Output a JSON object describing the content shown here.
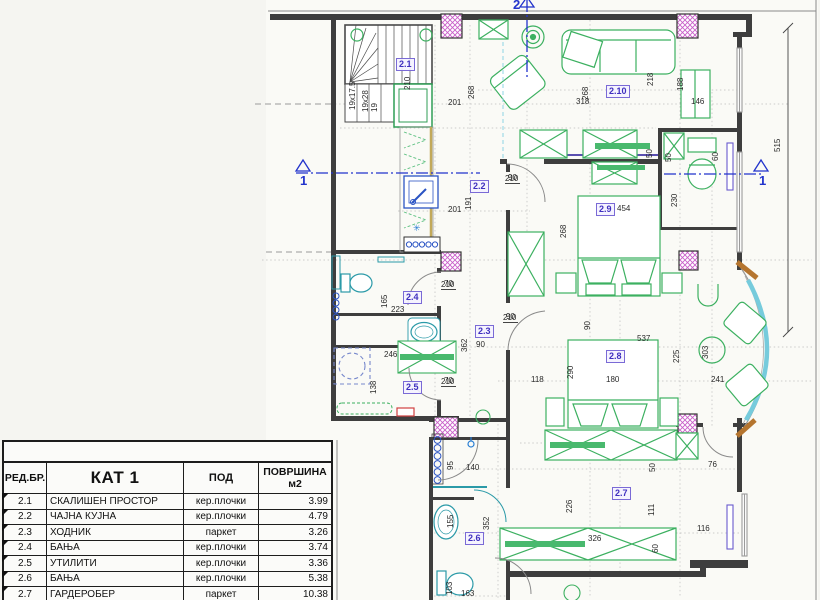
{
  "colors": {
    "wall": "#3e3e3e",
    "furniture_green": "#3cb060",
    "fixture_cyan": "#2b9aa8",
    "plumbing_blue": "#2b54c4",
    "column_magenta": "#c95fc9",
    "section_blue": "#2233cc",
    "bay_brown": "#b5752f",
    "counter_khaki": "#c2a95a",
    "accent_red": "#d04040",
    "label_purple": "#3f2fbf"
  },
  "table": {
    "headers": {
      "col_no": "РЕД.БР.",
      "col_name": "КАТ 1",
      "col_floor": "ПОД",
      "col_area_1": "ПОВРШИНА",
      "col_area_2": "м2"
    },
    "rows": [
      {
        "no": "2.1",
        "name": "СКАЛИШЕН ПРОСТОР",
        "floor": "кер.плочки",
        "area": "3.99"
      },
      {
        "no": "2.2",
        "name": "ЧАЈНА КУЈНА",
        "floor": "кер.плочки",
        "area": "4.79"
      },
      {
        "no": "2.3",
        "name": "ХОДНИК",
        "floor": "паркет",
        "area": "3.26"
      },
      {
        "no": "2.4",
        "name": "БАЊА",
        "floor": "кер.плочки",
        "area": "3.74"
      },
      {
        "no": "2.5",
        "name": "УТИЛИТИ",
        "floor": "кер.плочки",
        "area": "3.36"
      },
      {
        "no": "2.6",
        "name": "БАЊА",
        "floor": "кер.плочки",
        "area": "5.38"
      },
      {
        "no": "2.7",
        "name": "ГАРДЕРОБЕР",
        "floor": "паркет",
        "area": "10.38"
      },
      {
        "no": "2.8",
        "name": "СПАЛНА СОБА 1",
        "floor": "паркет",
        "area": "15.38"
      }
    ]
  },
  "plan": {
    "rooms": [
      {
        "t": "2.1",
        "x": 396,
        "y": 58
      },
      {
        "t": "2.2",
        "x": 470,
        "y": 180
      },
      {
        "t": "2.3",
        "x": 475,
        "y": 325
      },
      {
        "t": "2.4",
        "x": 403,
        "y": 291
      },
      {
        "t": "2.5",
        "x": 403,
        "y": 381
      },
      {
        "t": "2.6",
        "x": 465,
        "y": 532
      },
      {
        "t": "2.7",
        "x": 612,
        "y": 487
      },
      {
        "t": "2.8",
        "x": 606,
        "y": 350
      },
      {
        "t": "2.9",
        "x": 596,
        "y": 203
      },
      {
        "t": "2.10",
        "x": 606,
        "y": 85
      }
    ],
    "dims": [
      {
        "t": "210",
        "x": 404,
        "y": 90,
        "r": 1
      },
      {
        "t": "19x17.5",
        "x": 349,
        "y": 110,
        "r": 1
      },
      {
        "t": "19x28",
        "x": 362,
        "y": 112,
        "r": 1
      },
      {
        "t": "19",
        "x": 371,
        "y": 112,
        "r": 1
      },
      {
        "t": "201",
        "x": 448,
        "y": 99
      },
      {
        "t": "268",
        "x": 468,
        "y": 99,
        "r": 1
      },
      {
        "t": "201",
        "x": 448,
        "y": 206
      },
      {
        "t": "191",
        "x": 465,
        "y": 210,
        "r": 1
      },
      {
        "t": "268",
        "x": 582,
        "y": 100,
        "r": 1
      },
      {
        "t": "318",
        "x": 576,
        "y": 98
      },
      {
        "t": "218",
        "x": 647,
        "y": 86,
        "r": 1
      },
      {
        "t": "188",
        "x": 677,
        "y": 91,
        "r": 1
      },
      {
        "t": "146",
        "x": 691,
        "y": 98
      },
      {
        "t": "50",
        "x": 646,
        "y": 158,
        "r": 1
      },
      {
        "t": "50",
        "x": 665,
        "y": 162,
        "r": 1
      },
      {
        "t": "60",
        "x": 712,
        "y": 161,
        "r": 1
      },
      {
        "t": "230",
        "x": 671,
        "y": 207,
        "r": 1
      },
      {
        "t": "515",
        "x": 774,
        "y": 152,
        "r": 1
      },
      {
        "t": "454",
        "x": 617,
        "y": 205
      },
      {
        "t": "268",
        "x": 560,
        "y": 238,
        "r": 1
      },
      {
        "t": "223",
        "x": 391,
        "y": 306
      },
      {
        "t": "165",
        "x": 381,
        "y": 308,
        "r": 1
      },
      {
        "t": "246",
        "x": 384,
        "y": 351
      },
      {
        "t": "138",
        "x": 370,
        "y": 394,
        "r": 1
      },
      {
        "t": "362",
        "x": 461,
        "y": 352,
        "r": 1
      },
      {
        "t": "90",
        "x": 476,
        "y": 341
      },
      {
        "t": "90",
        "x": 584,
        "y": 330,
        "r": 1
      },
      {
        "t": "537",
        "x": 637,
        "y": 335
      },
      {
        "t": "290",
        "x": 567,
        "y": 379,
        "r": 1
      },
      {
        "t": "118",
        "x": 531,
        "y": 376
      },
      {
        "t": "180",
        "x": 606,
        "y": 376
      },
      {
        "t": "225",
        "x": 673,
        "y": 363,
        "r": 1
      },
      {
        "t": "303",
        "x": 702,
        "y": 359,
        "r": 1
      },
      {
        "t": "241",
        "x": 711,
        "y": 376
      },
      {
        "t": "95",
        "x": 447,
        "y": 470,
        "r": 1
      },
      {
        "t": "140",
        "x": 466,
        "y": 464
      },
      {
        "t": "155",
        "x": 447,
        "y": 528,
        "r": 1
      },
      {
        "t": "352",
        "x": 483,
        "y": 530,
        "r": 1
      },
      {
        "t": "103",
        "x": 446,
        "y": 595,
        "r": 1
      },
      {
        "t": "163",
        "x": 461,
        "y": 590
      },
      {
        "t": "226",
        "x": 566,
        "y": 513,
        "r": 1
      },
      {
        "t": "326",
        "x": 588,
        "y": 535
      },
      {
        "t": "50",
        "x": 649,
        "y": 472,
        "r": 1
      },
      {
        "t": "111",
        "x": 648,
        "y": 516,
        "r": 1
      },
      {
        "t": "60",
        "x": 652,
        "y": 553,
        "r": 1
      },
      {
        "t": "76",
        "x": 708,
        "y": 461
      },
      {
        "t": "116",
        "x": 697,
        "y": 525
      },
      {
        "t": "✳",
        "x": 413,
        "y": 224,
        "c": "star"
      }
    ],
    "doors": [
      {
        "top": "90",
        "bottom": "210",
        "x": 505,
        "y": 174
      },
      {
        "top": "90",
        "bottom": "210",
        "x": 503,
        "y": 313
      },
      {
        "top": "70",
        "bottom": "210",
        "x": 441,
        "y": 280
      },
      {
        "top": "70",
        "bottom": "210",
        "x": 441,
        "y": 377
      }
    ],
    "sections": [
      {
        "label": "1",
        "x": 300,
        "y": 174
      },
      {
        "label": "1",
        "x": 759,
        "y": 174
      },
      {
        "label": "2",
        "x": 513,
        "y": -2
      }
    ]
  }
}
